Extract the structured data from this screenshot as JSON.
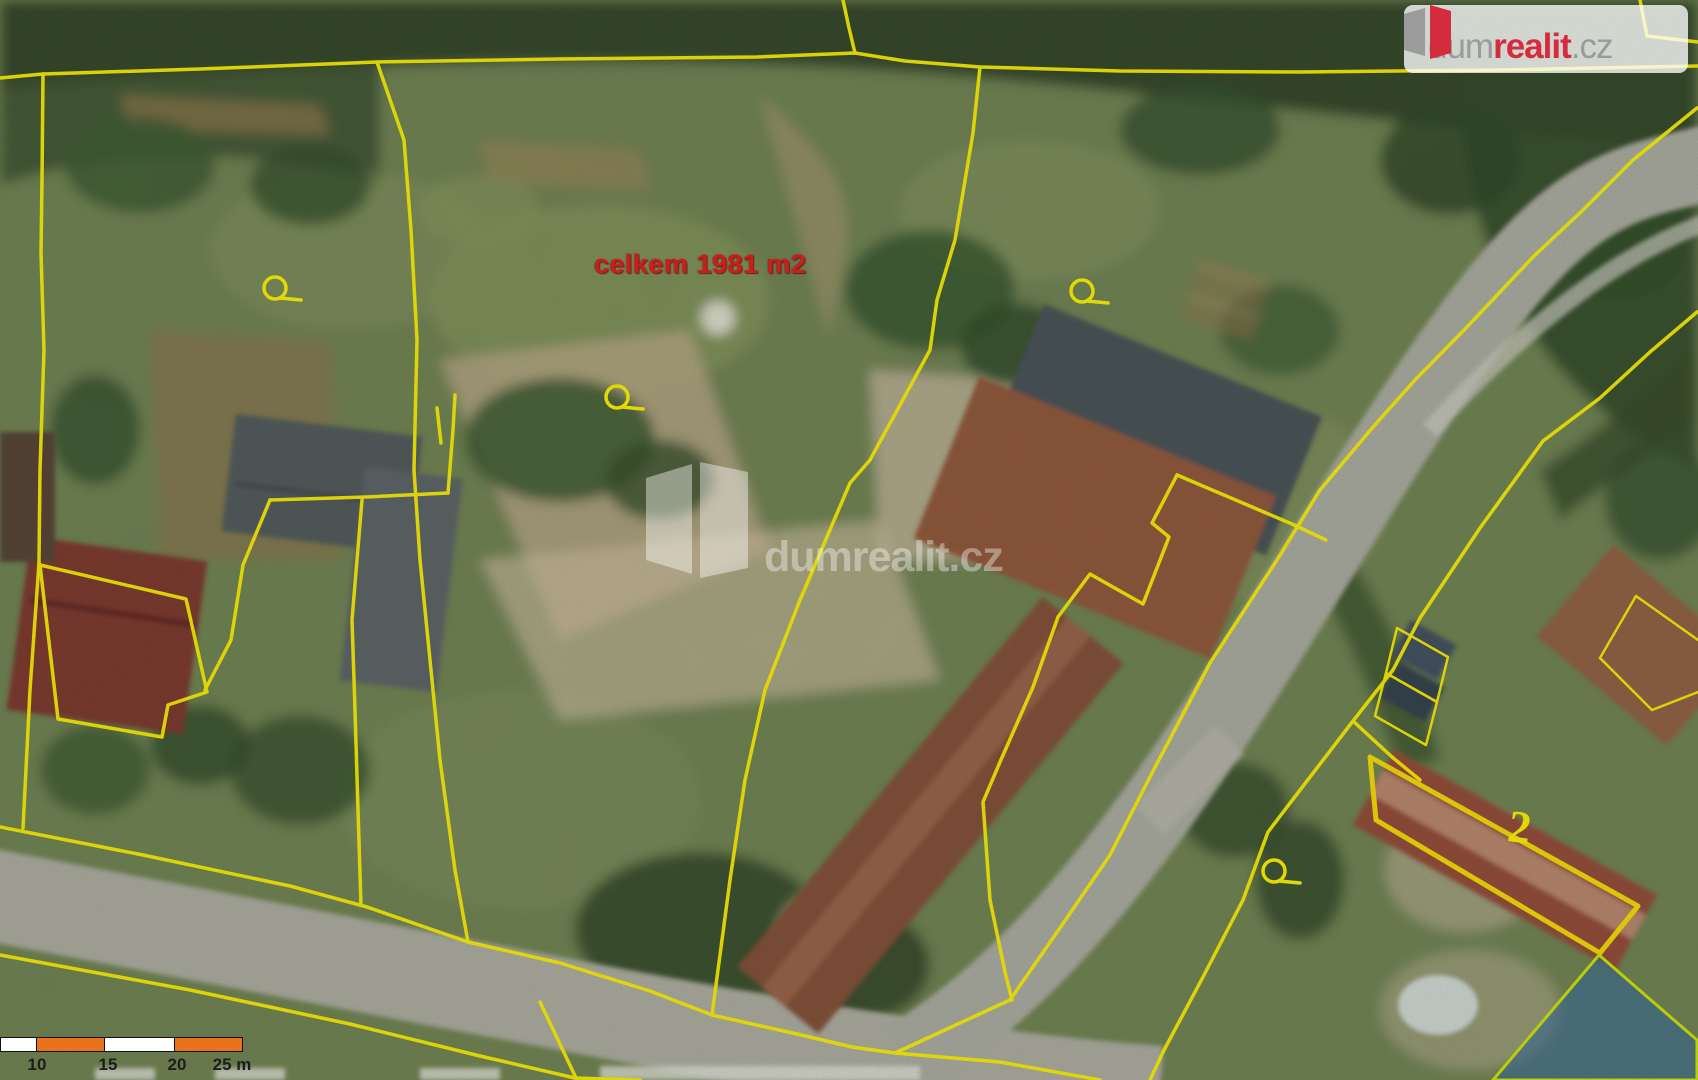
{
  "map": {
    "red_label": "celkem 1981 m2",
    "house_number_label": "2",
    "markers": [
      {
        "x": 275,
        "y": 288
      },
      {
        "x": 617,
        "y": 397
      },
      {
        "x": 1082,
        "y": 291
      },
      {
        "x": 1274,
        "y": 871
      }
    ]
  },
  "watermark": {
    "text": "dumrealit.cz"
  },
  "logo": {
    "dum": "dum",
    "realit": "realit",
    "cz": ".cz"
  },
  "scale_bar": {
    "segments": [
      {
        "width": 35,
        "color": "#ffffff"
      },
      {
        "width": 68,
        "color": "#e8731a"
      },
      {
        "width": 69,
        "color": "#ffffff"
      },
      {
        "width": 68,
        "color": "#e8731a"
      }
    ],
    "labels": [
      {
        "text": "10",
        "x": 97
      },
      {
        "text": "15",
        "x": 168
      },
      {
        "text": "20",
        "x": 237
      },
      {
        "text": "25 m",
        "x": 292
      }
    ]
  },
  "colors": {
    "parcel_yellow": "#f4e800",
    "highlight_fill": "rgba(40,96,160,0.55)",
    "highlight_stroke": "#c8dc00",
    "brand_red": "#d52b3f",
    "brand_gray": "#9b9b9b",
    "scale_orange": "#e8731a"
  }
}
